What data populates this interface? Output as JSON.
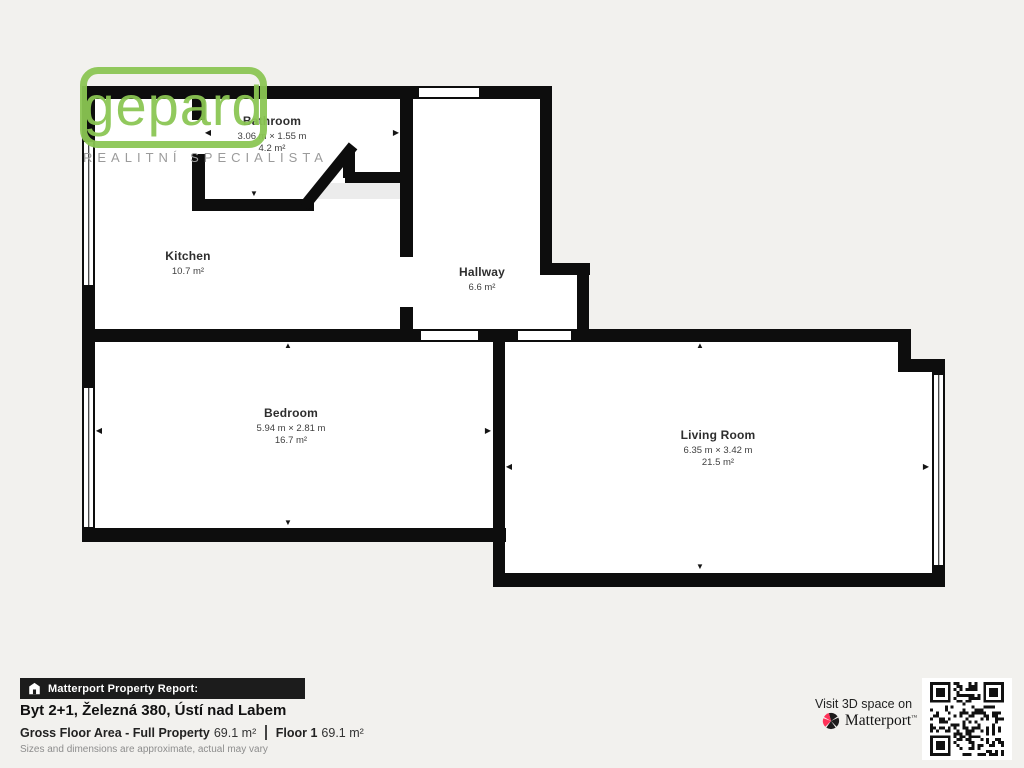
{
  "page": {
    "bg": "#f2f1ee",
    "wall": "#0d0d0d"
  },
  "logo": {
    "brand": "gepard",
    "tagline": "REALITNÍ SPECIALISTA",
    "green": "#8bc653"
  },
  "plan": {
    "rooms": [
      {
        "name": "Bathroom",
        "dims": "3.06 m × 1.55 m",
        "area": "4.2 m²"
      },
      {
        "name": "Kitchen",
        "area": "10.7 m²"
      },
      {
        "name": "Hallway",
        "area": "6.6 m²"
      },
      {
        "name": "Bedroom",
        "dims": "5.94 m × 2.81 m",
        "area": "16.7 m²"
      },
      {
        "name": "Living Room",
        "dims": "6.35 m × 3.42 m",
        "area": "21.5 m²"
      }
    ]
  },
  "footer": {
    "report_label": "Matterport Property Report:",
    "property_title": "Byt 2+1, Železná 380, Ústí nad Labem",
    "gross_label": "Gross Floor Area - Full Property",
    "gross_value": "69.1 m²",
    "floor_label": "Floor 1",
    "floor_value": "69.1 m²",
    "disclaimer": "Sizes and dimensions are approximate, actual may vary",
    "visit_text": "Visit 3D space on",
    "brand": "Matterport",
    "tm": "™",
    "accent_red": "#ff3158"
  }
}
